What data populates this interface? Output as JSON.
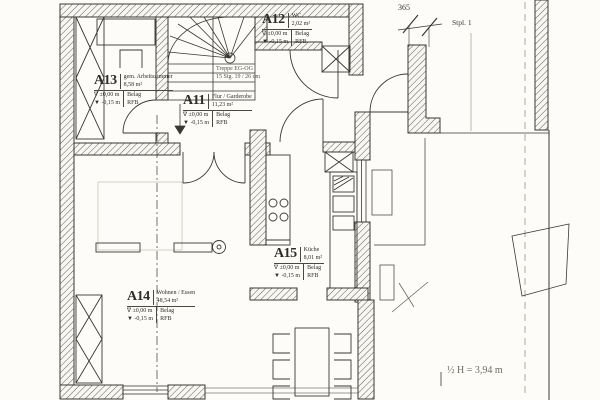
{
  "colors": {
    "paper": "#fdfcf9",
    "ink": "#3a3833",
    "hatch": "#4e4c45",
    "faint": "#c9c6bd",
    "gray_text": "#6e6b63"
  },
  "rooms": [
    {
      "code": "A13",
      "name": "gem. Arbeitszimmer",
      "area": "8,58 m²",
      "level_top": "∇ ±0,00 m",
      "finish_top": "Belag",
      "level_bottom": "▼ -0,15 m",
      "finish_bottom": "RFB"
    },
    {
      "code": "A12",
      "name": "WC",
      "area": "2,02 m²",
      "level_top": "∇ ±0,00 m",
      "finish_top": "Belag",
      "level_bottom": "▼ -0,15 m",
      "finish_bottom": "RFB"
    },
    {
      "code": "A11",
      "name": "Flur / Garderobe",
      "area": "11,23 m²",
      "level_top": "∇ ±0,00 m",
      "finish_top": "Belag",
      "level_bottom": "▼ -0,15 m",
      "finish_bottom": "RFB"
    },
    {
      "code": "A15",
      "name": "Küche",
      "area": "8,01 m²",
      "level_top": "∇ ±0,00 m",
      "finish_top": "Belag",
      "level_bottom": "▼ -0,15 m",
      "finish_bottom": "RFB"
    },
    {
      "code": "A14",
      "name": "Wohnen / Essen",
      "area": "48,54 m²",
      "level_top": "∇ ±0,00 m",
      "finish_top": "Belag",
      "level_bottom": "▼ -0,15 m",
      "finish_bottom": "RFB"
    }
  ],
  "stair_note": {
    "line1": "Treppe EG-OG",
    "line2": "15 Stg. 19 / 26 cm"
  },
  "annotations": {
    "parking": "Stpl. 1",
    "dimension": "365",
    "height_note": "½ H = 3,94 m"
  }
}
